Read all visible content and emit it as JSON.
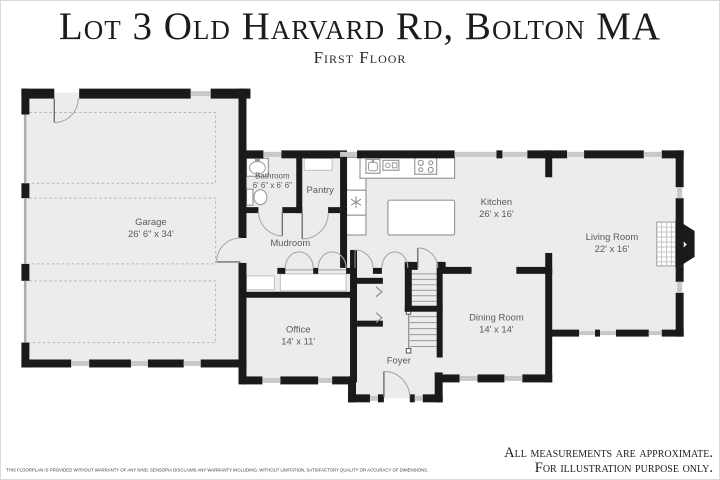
{
  "header": {
    "title": "Lot 3 Old Harvard Rd, Bolton MA",
    "subtitle": "First Floor"
  },
  "rooms": {
    "garage": {
      "name": "Garage",
      "dims": "26' 6\" x 34'"
    },
    "bathroom": {
      "name": "Bathroom",
      "dims": "6' 6\" x 6' 6\""
    },
    "pantry": {
      "name": "Pantry"
    },
    "mudroom": {
      "name": "Mudroom"
    },
    "kitchen": {
      "name": "Kitchen",
      "dims": "26' x 16'"
    },
    "living_room": {
      "name": "Living Room",
      "dims": "22' x 16'"
    },
    "office": {
      "name": "Office",
      "dims": "14' x 11'"
    },
    "foyer": {
      "name": "Foyer"
    },
    "dining_room": {
      "name": "Dining Room",
      "dims": "14' x 14'"
    }
  },
  "footer": {
    "disclaimer": "THIS FLOORPLAN IS PROVIDED WITHOUT WARRANTY OF ANY KIND. SENSOPIA DISCLAIMS ANY WARRANTY INCLUDING, WITHOUT LIMITATION, SATISFACTORY QUALITY OR ACCURACY OF DIMENSIONS.",
    "note_line1": "All measurements are approximate.",
    "note_line2": "For illustration purpose only."
  },
  "colors": {
    "wall": "#1a1a1a",
    "floor": "#ececec",
    "window": "#c8c8c8",
    "label": "#5a5a5a"
  }
}
